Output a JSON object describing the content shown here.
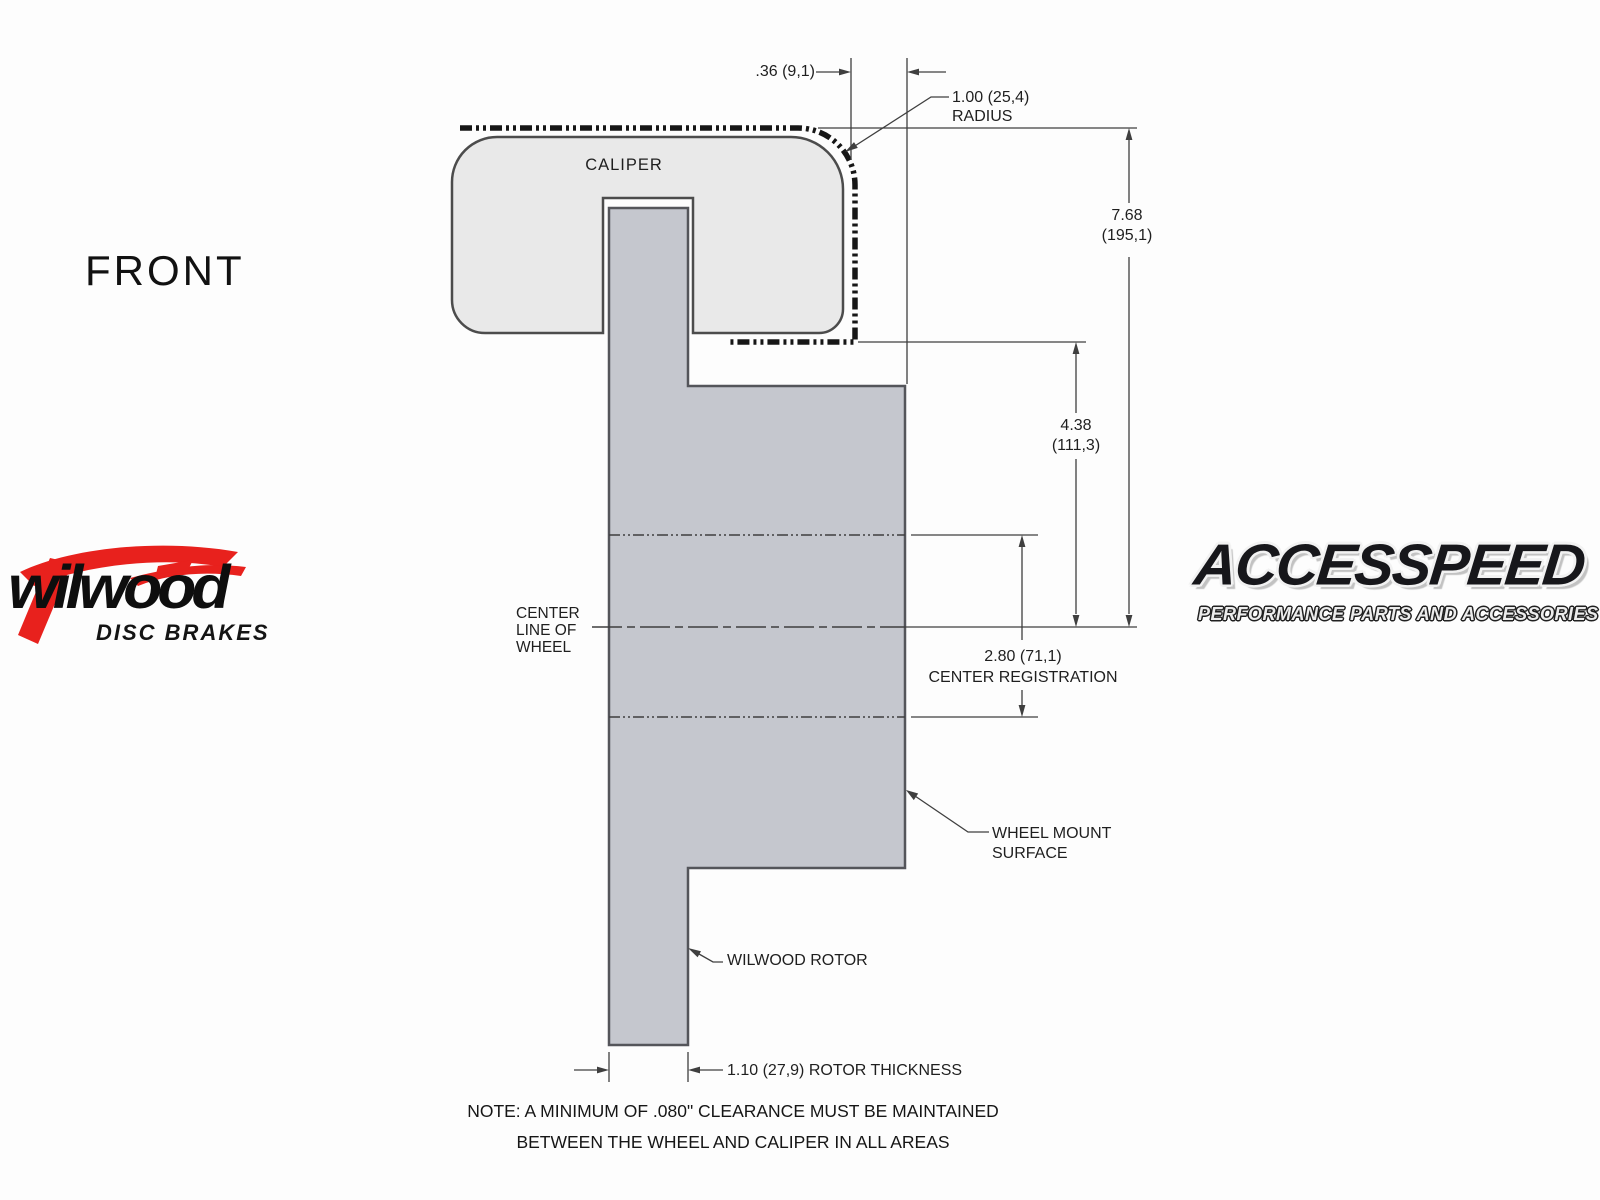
{
  "view_label": "FRONT",
  "drawing": {
    "caliper_label": "CALIPER",
    "centerline_label": [
      "CENTER",
      "LINE OF",
      "WHEEL"
    ],
    "wheel_mount_label": [
      "WHEEL MOUNT",
      "SURFACE"
    ],
    "rotor_label": "WILWOOD ROTOR",
    "dims": {
      "caliper_offset": ".36 (9,1)",
      "radius": [
        "1.00 (25,4)",
        "RADIUS"
      ],
      "overall_height": [
        "7.68",
        "(195,1)"
      ],
      "mount_to_center": [
        "4.38",
        "(111,3)"
      ],
      "center_registration": [
        "2.80 (71,1)",
        "CENTER REGISTRATION"
      ],
      "rotor_thickness": "1.10 (27,9) ROTOR THICKNESS"
    },
    "note_line1": "NOTE: A MINIMUM OF .080\" CLEARANCE MUST BE MAINTAINED",
    "note_line2": "BETWEEN THE WHEEL AND CALIPER IN ALL AREAS"
  },
  "logos": {
    "wilwood": {
      "wordmark": "wilwood",
      "tagline": "DISC BRAKES"
    },
    "accesspeed": {
      "wordmark": "ACCESSPEED",
      "tagline": "PERFORMANCE PARTS AND ACCESSORIES"
    }
  },
  "colors": {
    "caliper_fill": "#e9e9e9",
    "rotor_fill": "#c5c7ce",
    "outline": "#4c4c4c",
    "dimension_line": "#3f3f3f",
    "clearance_line": "#161616",
    "wilwood_red": "#e8211d",
    "text": "#1f1f1f"
  }
}
